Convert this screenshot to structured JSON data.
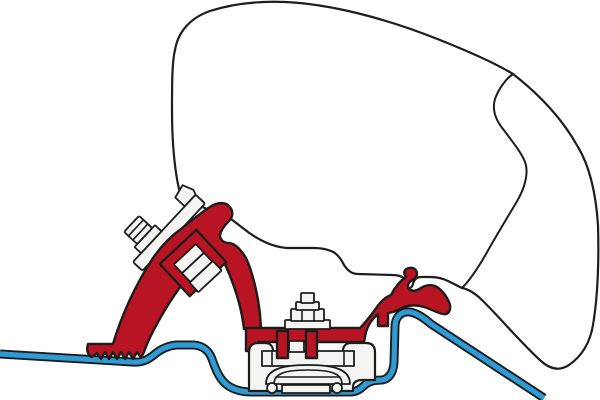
{
  "canvas": {
    "width": 600,
    "height": 400,
    "background": "#ffffff"
  },
  "palette": {
    "outline": "#1d1d1b",
    "case_fill": "#ffffff",
    "bracket_red": "#b91423",
    "roof_blue": "#2f9bd6",
    "hardware_fill": "#f4f4f2"
  },
  "components": [
    {
      "name": "awning-case-profile",
      "kind": "outlined-shape"
    },
    {
      "name": "case-seam-line",
      "kind": "outline"
    },
    {
      "name": "vehicle-roof-profile",
      "kind": "blue-line"
    },
    {
      "name": "adapter-bracket",
      "kind": "red-shape"
    },
    {
      "name": "bracket-serrated-foot",
      "kind": "red-shape"
    },
    {
      "name": "bracket-rail-anchor",
      "kind": "red-shape"
    },
    {
      "name": "mounting-plate",
      "kind": "hardware"
    },
    {
      "name": "hex-bolt",
      "kind": "hardware"
    },
    {
      "name": "clamp-nut-blocks",
      "kind": "hardware"
    },
    {
      "name": "roof-rail-clamp",
      "kind": "hardware"
    },
    {
      "name": "center-bolt-stack",
      "kind": "hardware"
    }
  ]
}
